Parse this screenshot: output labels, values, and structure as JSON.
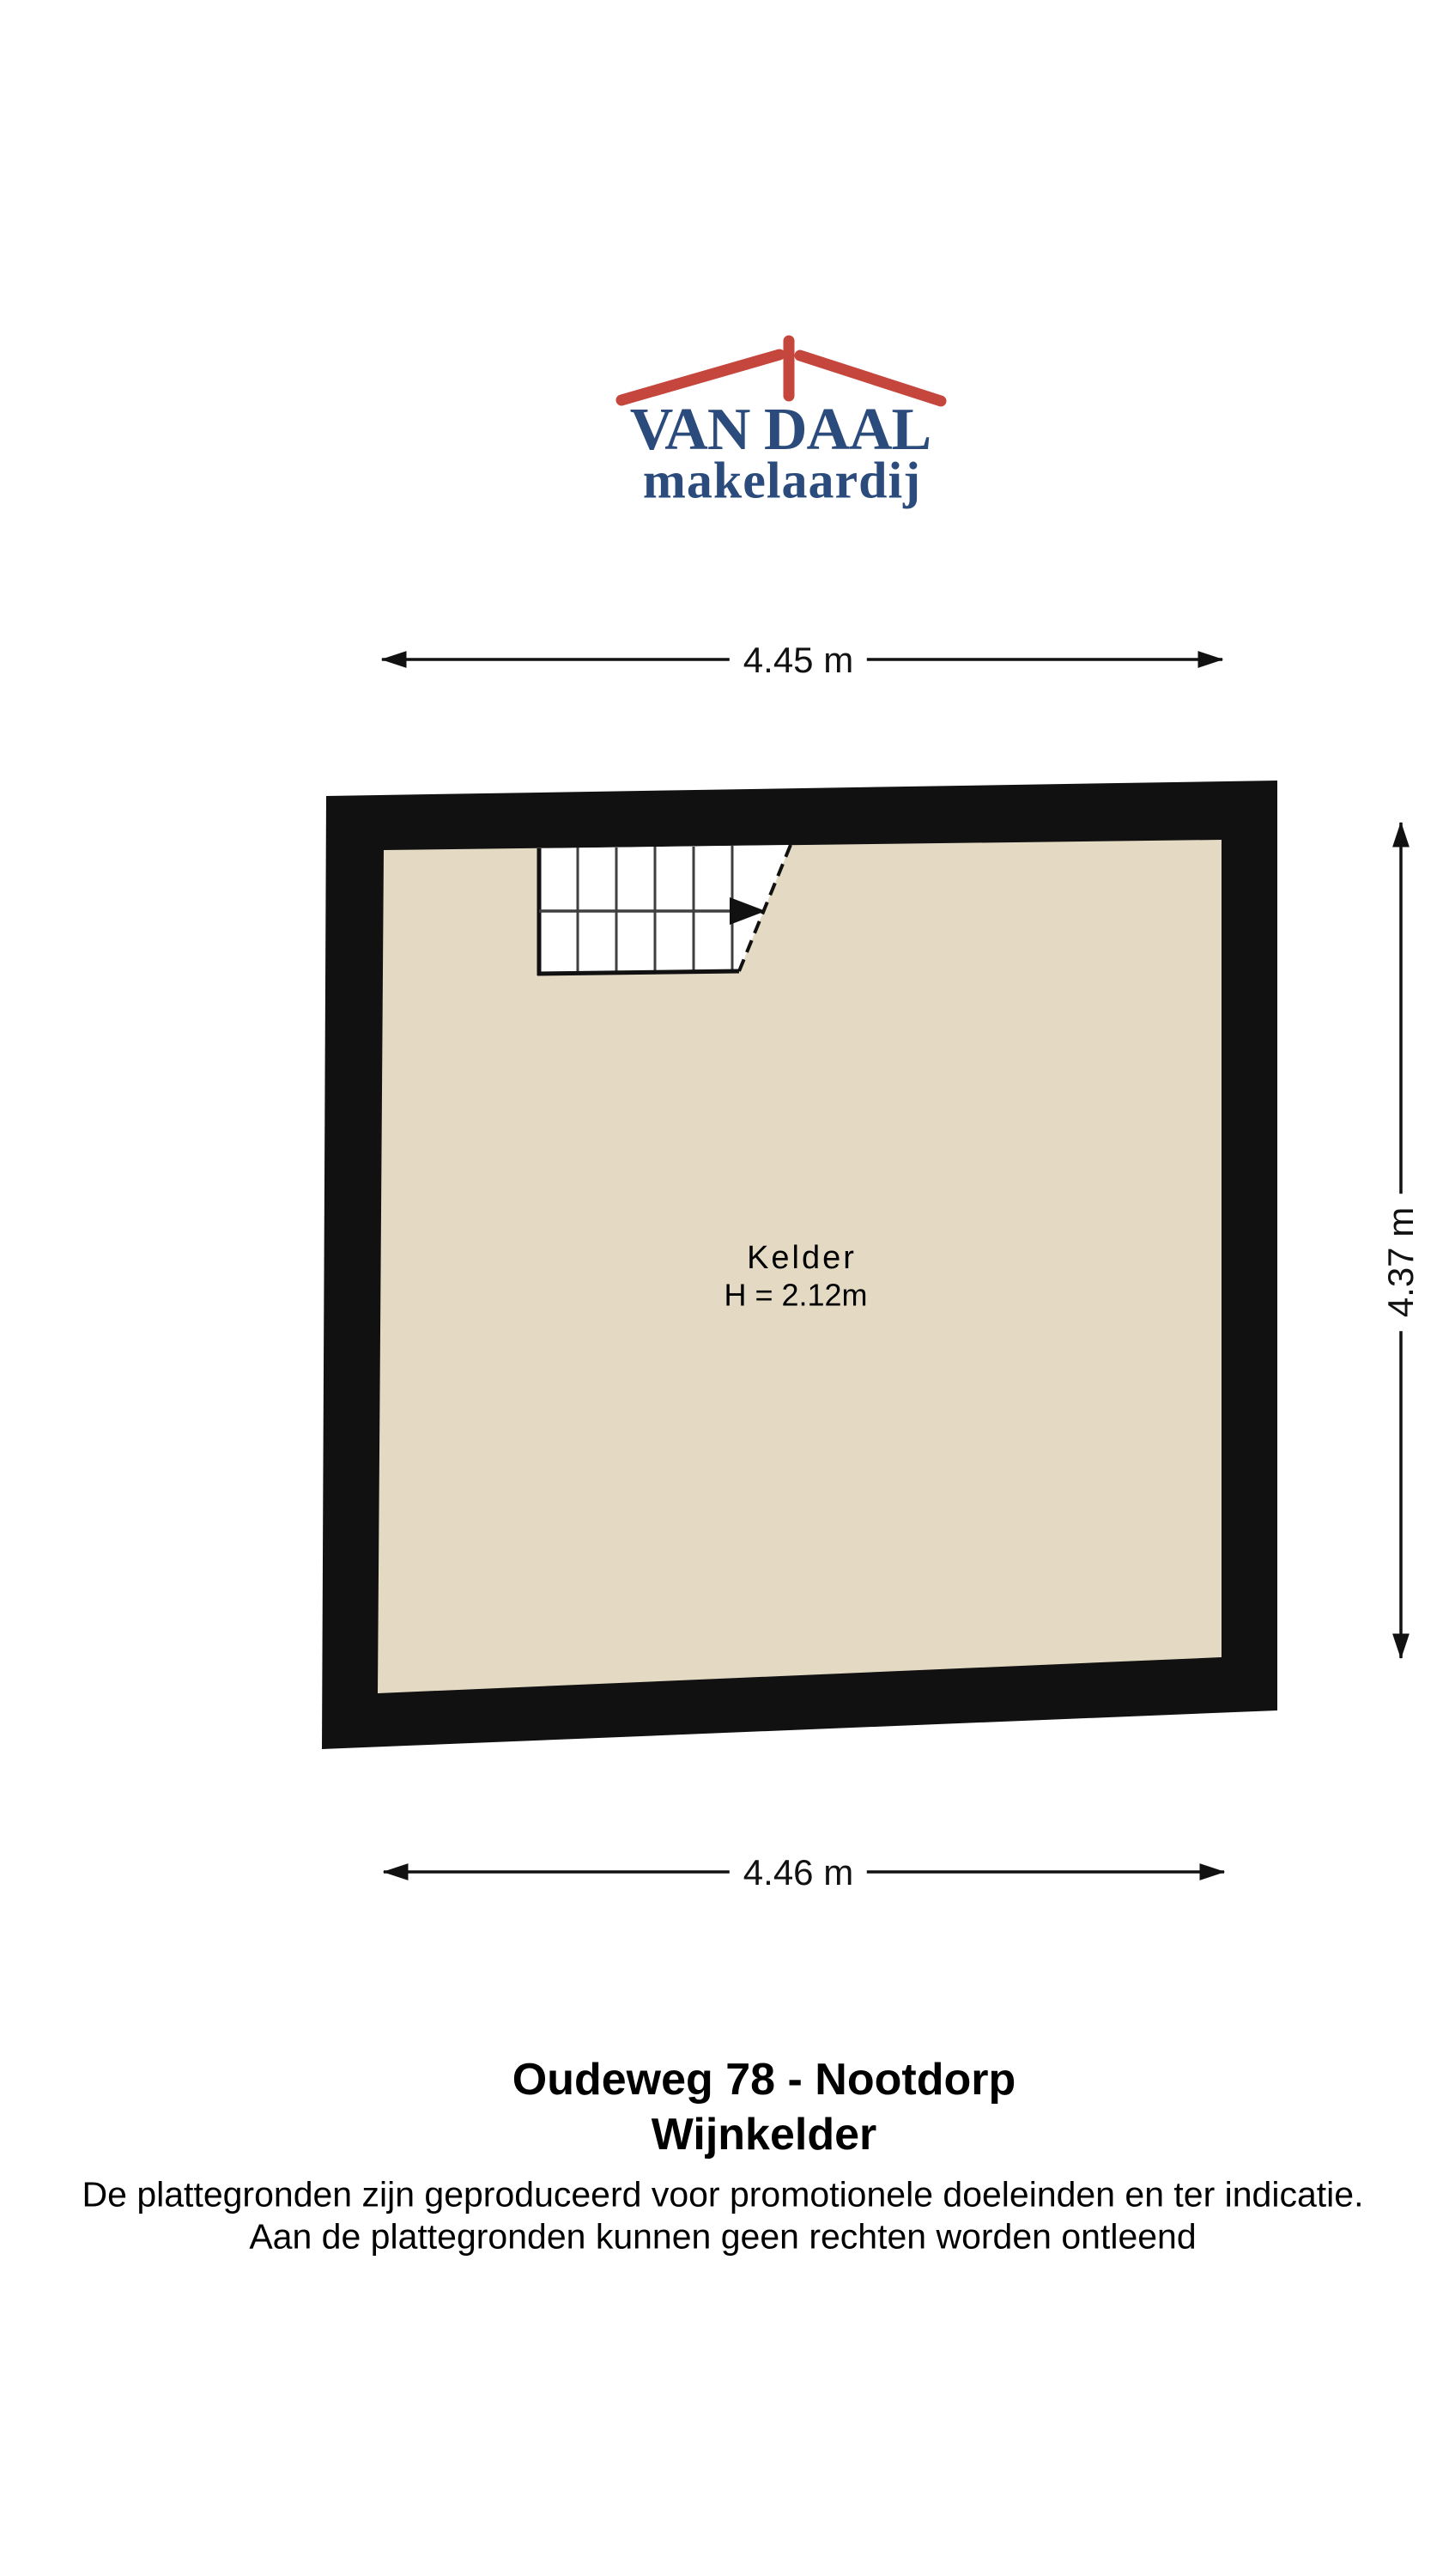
{
  "colors": {
    "roof-red": "#C5463D",
    "logo-navy": "#2A4B7C",
    "wall": "#111111",
    "floor": "#E4DAC3",
    "stairs": "#FFFFFF",
    "stair-line": "#3F3F3F",
    "ink": "#111111"
  },
  "logo": {
    "name": "VAN DAAL",
    "tagline": "makelaardij"
  },
  "plan": {
    "room": {
      "label": "Kelder",
      "ceiling_height": "H = 2.12m"
    },
    "dimensions": {
      "width_top": "4.45 m",
      "height_right": "4.37 m",
      "width_bottom": "4.46 m"
    }
  },
  "footer": {
    "address": "Oudeweg 78 - Nootdorp",
    "floor_label": "Wijnkelder",
    "disclaimer": [
      "De plattegronden zijn geproduceerd voor promotionele doeleinden en ter indicatie.",
      "Aan de plattegronden kunnen geen rechten worden ontleend"
    ]
  }
}
